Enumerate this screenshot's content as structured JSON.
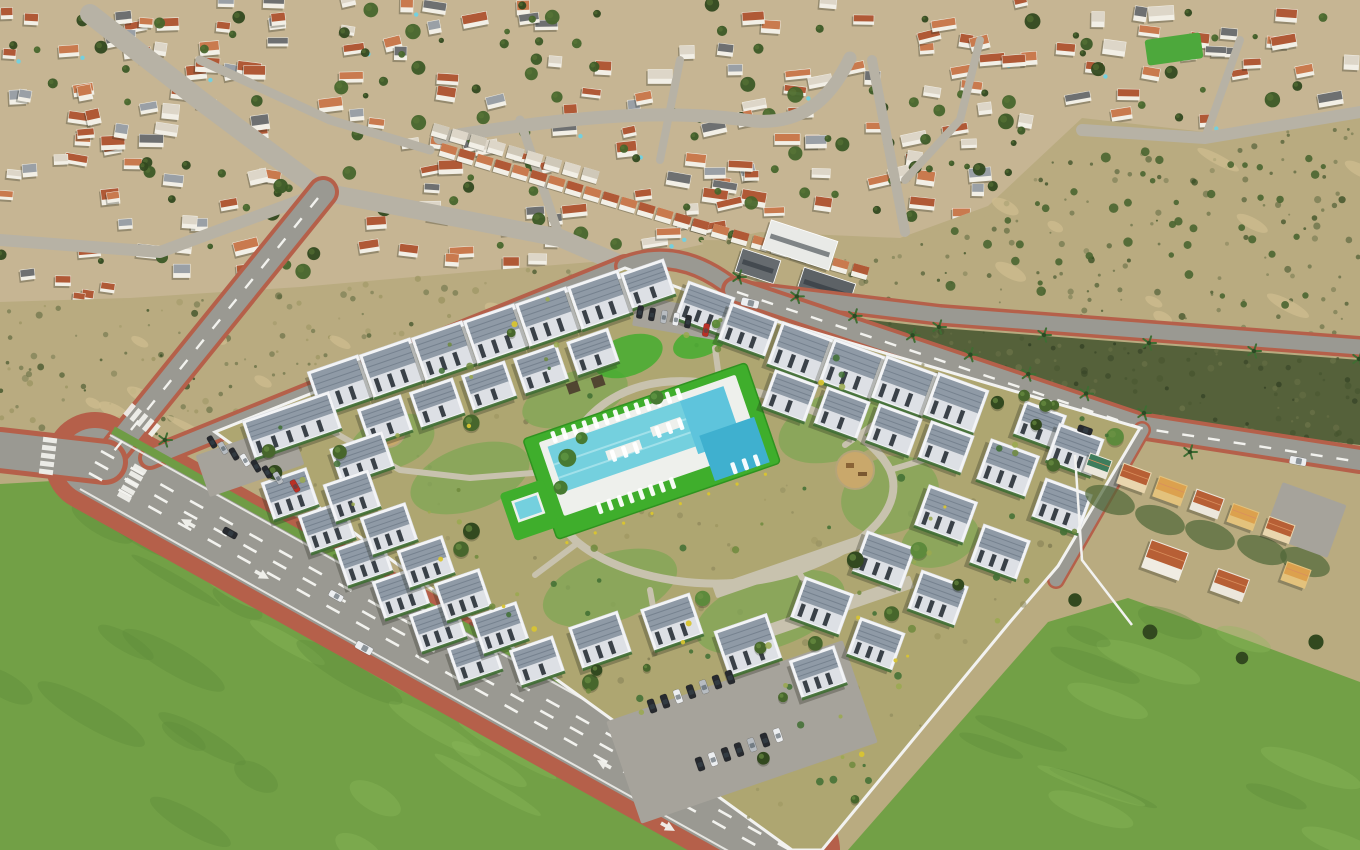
{
  "meta": {
    "title": "Aerial 3D render of a new-build white residential complex with communal pool and gardens, surrounded by a dense suburb of terracotta-roofed villas, scrubland, palm-lined roads and green fields",
    "width": 1360,
    "height": 850,
    "seed": 11
  },
  "palette": {
    "suburb_ground": "#c6b593",
    "suburb_road": "#b7b2a5",
    "house_white": "#f2efe6",
    "roof_terracotta": "#b05936",
    "roof_terracotta2": "#c97a4e",
    "roof_pale": "#ddd6c8",
    "roof_grey": "#9aa0a6",
    "tree_dark": "#32491f",
    "tree_mid": "#47662c",
    "scrub_base": "#b9ab80",
    "scrub_dark": "#6d7449",
    "scrub_strip": "#55613a",
    "field_green": "#72a046",
    "field_light": "#8cba5c",
    "field_dark": "#5c8a3a",
    "asphalt": "#9a9992",
    "asphalt_light": "#a6a39b",
    "sidewalk_red": "#b5604a",
    "lane_white": "#f2f2ee",
    "plot_ground": "#aea671",
    "path_light": "#c8c2ae",
    "garden_green": "#7fa654",
    "lawn_bright": "#3fae2c",
    "pool_water": "#74d0de",
    "pool_mid": "#5ec4dc",
    "pool_deep": "#3fb0cf",
    "pool_deck": "#eef0ec",
    "bld_white": "#f3f4f6",
    "bld_side": "#dde0e5",
    "roof_solar": "#8f9aa6",
    "roof_solar_dark": "#76828f",
    "window_dark": "#3a4148",
    "hedge_green": "#3f6e33",
    "wall_white": "#f2f2f0",
    "car_dark": "#272a2f",
    "car_white": "#eceef0",
    "car_red": "#b93026",
    "car_silver": "#b7bcc1",
    "orange_deep": "#dca14e",
    "roof_orange": "#b75f35",
    "roof_green": "#3e7c5c",
    "verge_green": "#6f9c45",
    "sports_green": "#4da83c",
    "shadow": "rgba(35,40,28,0.3)"
  },
  "scene": {
    "suburb": {
      "houses": 215,
      "trees": 135
    },
    "orchard_trees": 45,
    "scrub": {
      "speckles_left": 140,
      "speckles_right": 150,
      "speckles_strip": 120
    },
    "fields": {
      "streaks_bottom_left": 22,
      "streaks_bottom_right": 14
    },
    "development": {
      "buildings": 50,
      "ground_speckles": 130,
      "garden_trees": 30,
      "garden_shrubs": 85,
      "flower_patches": 16,
      "pool_loungers": 30
    },
    "palms_along_road": 15,
    "vehicles": {
      "avenue_cars": 3,
      "right_road_cars": 3,
      "west_parking_cars": 8,
      "north_lot_cars": 6,
      "south_parking_cars": 14,
      "orange_driveway_cars": 3
    }
  }
}
